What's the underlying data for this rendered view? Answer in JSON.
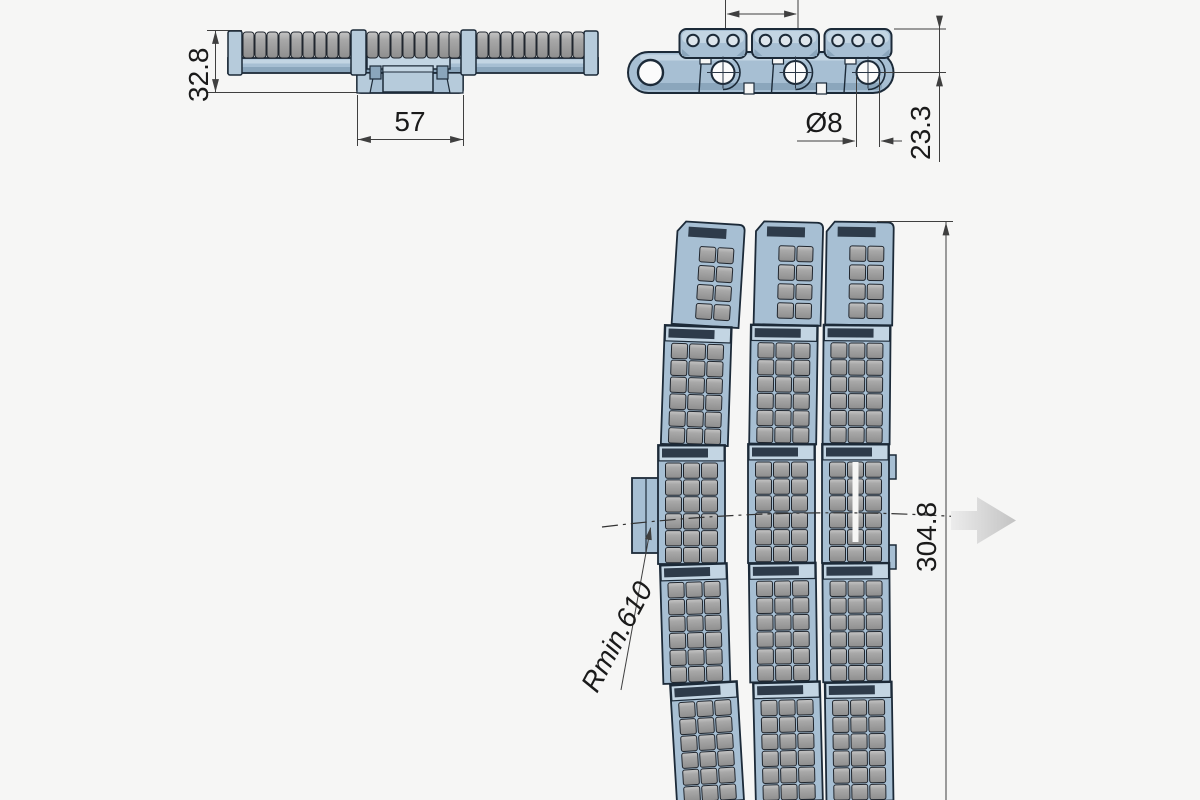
{
  "drawing": {
    "type": "technical-drawing",
    "subject": "roller-top side-flexing conveyor chain / modular belt",
    "views": {
      "side_section_view": {
        "description": "front section view with top rollers and center hub",
        "dimensions": {
          "overall_height": "32.8",
          "hub_width": "57"
        }
      },
      "chain_side_view": {
        "description": "side elevation of chain links with pins and top plates",
        "dimensions": {
          "pin_diameter": "Ø8",
          "plate_top_to_pin_center": "23.3",
          "pitch_arrow_label": ""
        }
      },
      "plan_view": {
        "description": "top view of belt curving, three module rows with roller grids",
        "dimensions": {
          "belt_width": "304.8",
          "minimum_radius": "Rmin.610"
        }
      }
    },
    "icons": {
      "direction_arrow": "right-arrow"
    }
  },
  "labels": {
    "side_height": "32.8",
    "side_hub_width": "57",
    "pin_diameter": "Ø8",
    "pin_center_height": "23.3",
    "belt_width": "304.8",
    "min_radius": "Rmin.610"
  },
  "colors": {
    "background": "#f6f6f5",
    "body-blue": "#a7bfd3",
    "body-blue-light": "#c3d5e3",
    "body-blue-mid": "#b6cbdb",
    "body-blue-dark": "#8ba6bc",
    "outline-navy": "#1c2a38",
    "inset-dark": "#2e3b4a",
    "roller-light": "#c6c6c6",
    "roller-mid": "#a8a8a8",
    "roller-dark": "#8e8e8e",
    "dim-line": "#3f3f3f",
    "text-color": "#1a1a1a",
    "arrow-light": "#ececec",
    "arrow-dark": "#c3c3c3"
  }
}
